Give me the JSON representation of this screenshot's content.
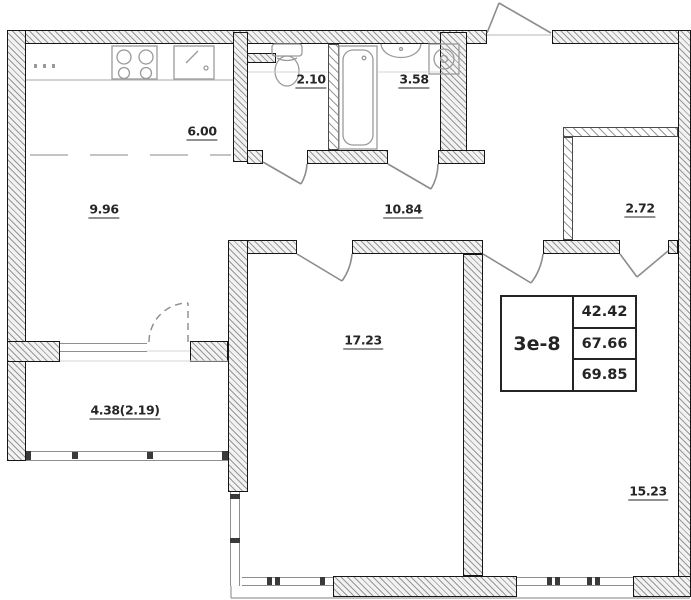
{
  "plan": {
    "rooms": [
      {
        "id": "kitchen-zone",
        "area": "6.00"
      },
      {
        "id": "wc",
        "area": "2.10"
      },
      {
        "id": "bathroom",
        "area": "3.58"
      },
      {
        "id": "living-zone",
        "area": "9.96"
      },
      {
        "id": "hallway",
        "area": "10.84"
      },
      {
        "id": "wardrobe",
        "area": "2.72"
      },
      {
        "id": "room-1",
        "area": "17.23"
      },
      {
        "id": "balcony",
        "area": "4.38(2.19)"
      },
      {
        "id": "bedroom",
        "area": "15.23"
      }
    ],
    "stamp": {
      "unit": "3е-8",
      "living_area": "42.42",
      "area": "67.66",
      "total_area": "69.85"
    },
    "colors": {
      "wall_line": "#161616",
      "thin_line": "#9a9a9a",
      "text": "#262626",
      "background": "#ffffff"
    }
  }
}
